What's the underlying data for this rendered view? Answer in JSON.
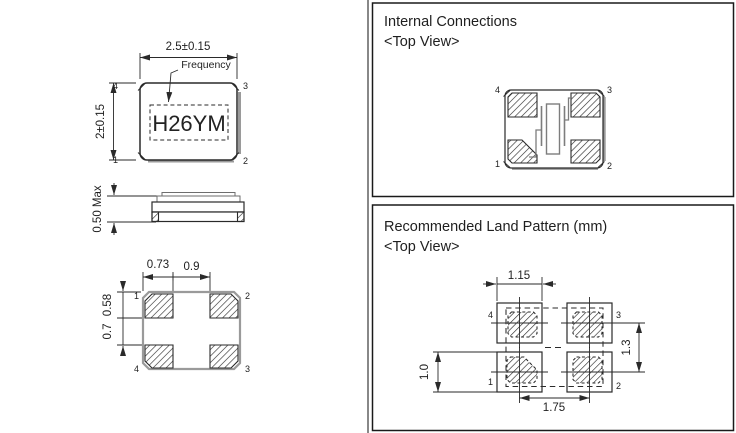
{
  "mechanical": {
    "top_view": {
      "dim_width": "2.5±0.15",
      "dim_height": "2±0.15",
      "frequency_label": "Frequency",
      "marking": "H26YM",
      "pin_tl": "4",
      "pin_tr": "3",
      "pin_bl": "1",
      "pin_br": "2"
    },
    "side_view": {
      "dim_height": "0.50 Max"
    },
    "bottom_view": {
      "dim_pad_width": "0.73",
      "dim_pad_gap": "0.9",
      "dim_pad_height": "0.58",
      "dim_row_gap": "0.7",
      "pin_tl": "1",
      "pin_tr": "2",
      "pin_bl": "4",
      "pin_br": "3"
    }
  },
  "internal_connections": {
    "title": "Internal Connections",
    "subtitle": "<Top View>",
    "pin_tl": "4",
    "pin_tr": "3",
    "pin_bl": "1",
    "pin_br": "2"
  },
  "land_pattern": {
    "title": "Recommended Land Pattern (mm)",
    "subtitle": "<Top View>",
    "dim_pad_width": "1.15",
    "dim_pitch_vertical": "1.3",
    "dim_pad_height": "1.0",
    "dim_pitch_horizontal": "1.75",
    "pin_tl": "4",
    "pin_tr": "3",
    "pin_bl": "1",
    "pin_br": "2"
  },
  "colors": {
    "line": "#2a2a2a",
    "shadow_gray": "#9a9a9a",
    "background": "#ffffff"
  }
}
